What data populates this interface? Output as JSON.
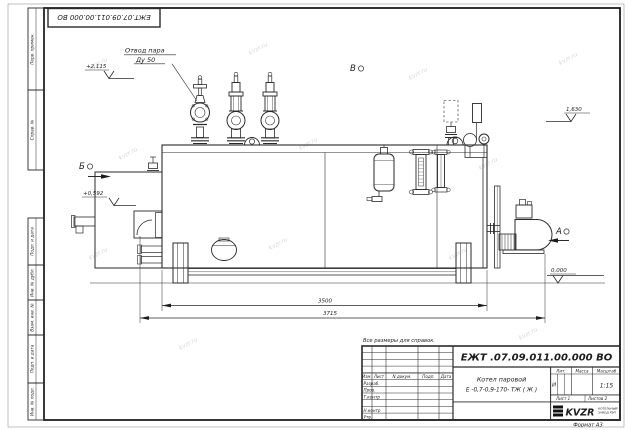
{
  "sheet": {
    "top_stamp": "ЕЖТ.07.09.011.00.000  ВО",
    "format": "Формат  А3",
    "note": "Все размеры для справок."
  },
  "watermark": "kvzr.ru",
  "margin": [
    "Перв. примен.",
    "Справ. №",
    "Подп. и дата",
    "Инв. № дубл.",
    "Взам. инв. №",
    "Подп. и дата",
    "Инв. № подл."
  ],
  "title_block": {
    "doc_number": "ЕЖТ .07.09.011.00.000  ВО",
    "name_line1": "Котел паровой",
    "name_line2": "Е -0,7-0,9-170- ТЖ ( Ж )",
    "headers": {
      "izm": "Изм.",
      "list": "Лист",
      "doc": "N докум.",
      "sign": "Подп.",
      "date": "Дата",
      "lit": "Лит.",
      "mass": "Масса",
      "scale": "Масштаб"
    },
    "rows": [
      "Разраб.",
      "Пров.",
      "Т.контр",
      "Н.контр",
      "Утв."
    ],
    "lit_value": "И",
    "scale_value": "1:15",
    "sheet_no": "Лист 1",
    "sheets_total": "Листов   2",
    "company": {
      "logo": "KVZR",
      "sub1": "КОТЕЛЬНЫЙ",
      "sub2": "ЗАВОД РЭП"
    }
  },
  "annotations": {
    "steam_line1": "Отвод пара",
    "steam_line2": "Ду 50",
    "view_b": "Б",
    "view_v": "В",
    "view_a": "А",
    "elev_top": "+2,115",
    "elev_mid": "+0,592",
    "elev_right": "1,630",
    "elev_zero": "0,000",
    "dim_body": "3500",
    "dim_overall": "3715"
  }
}
